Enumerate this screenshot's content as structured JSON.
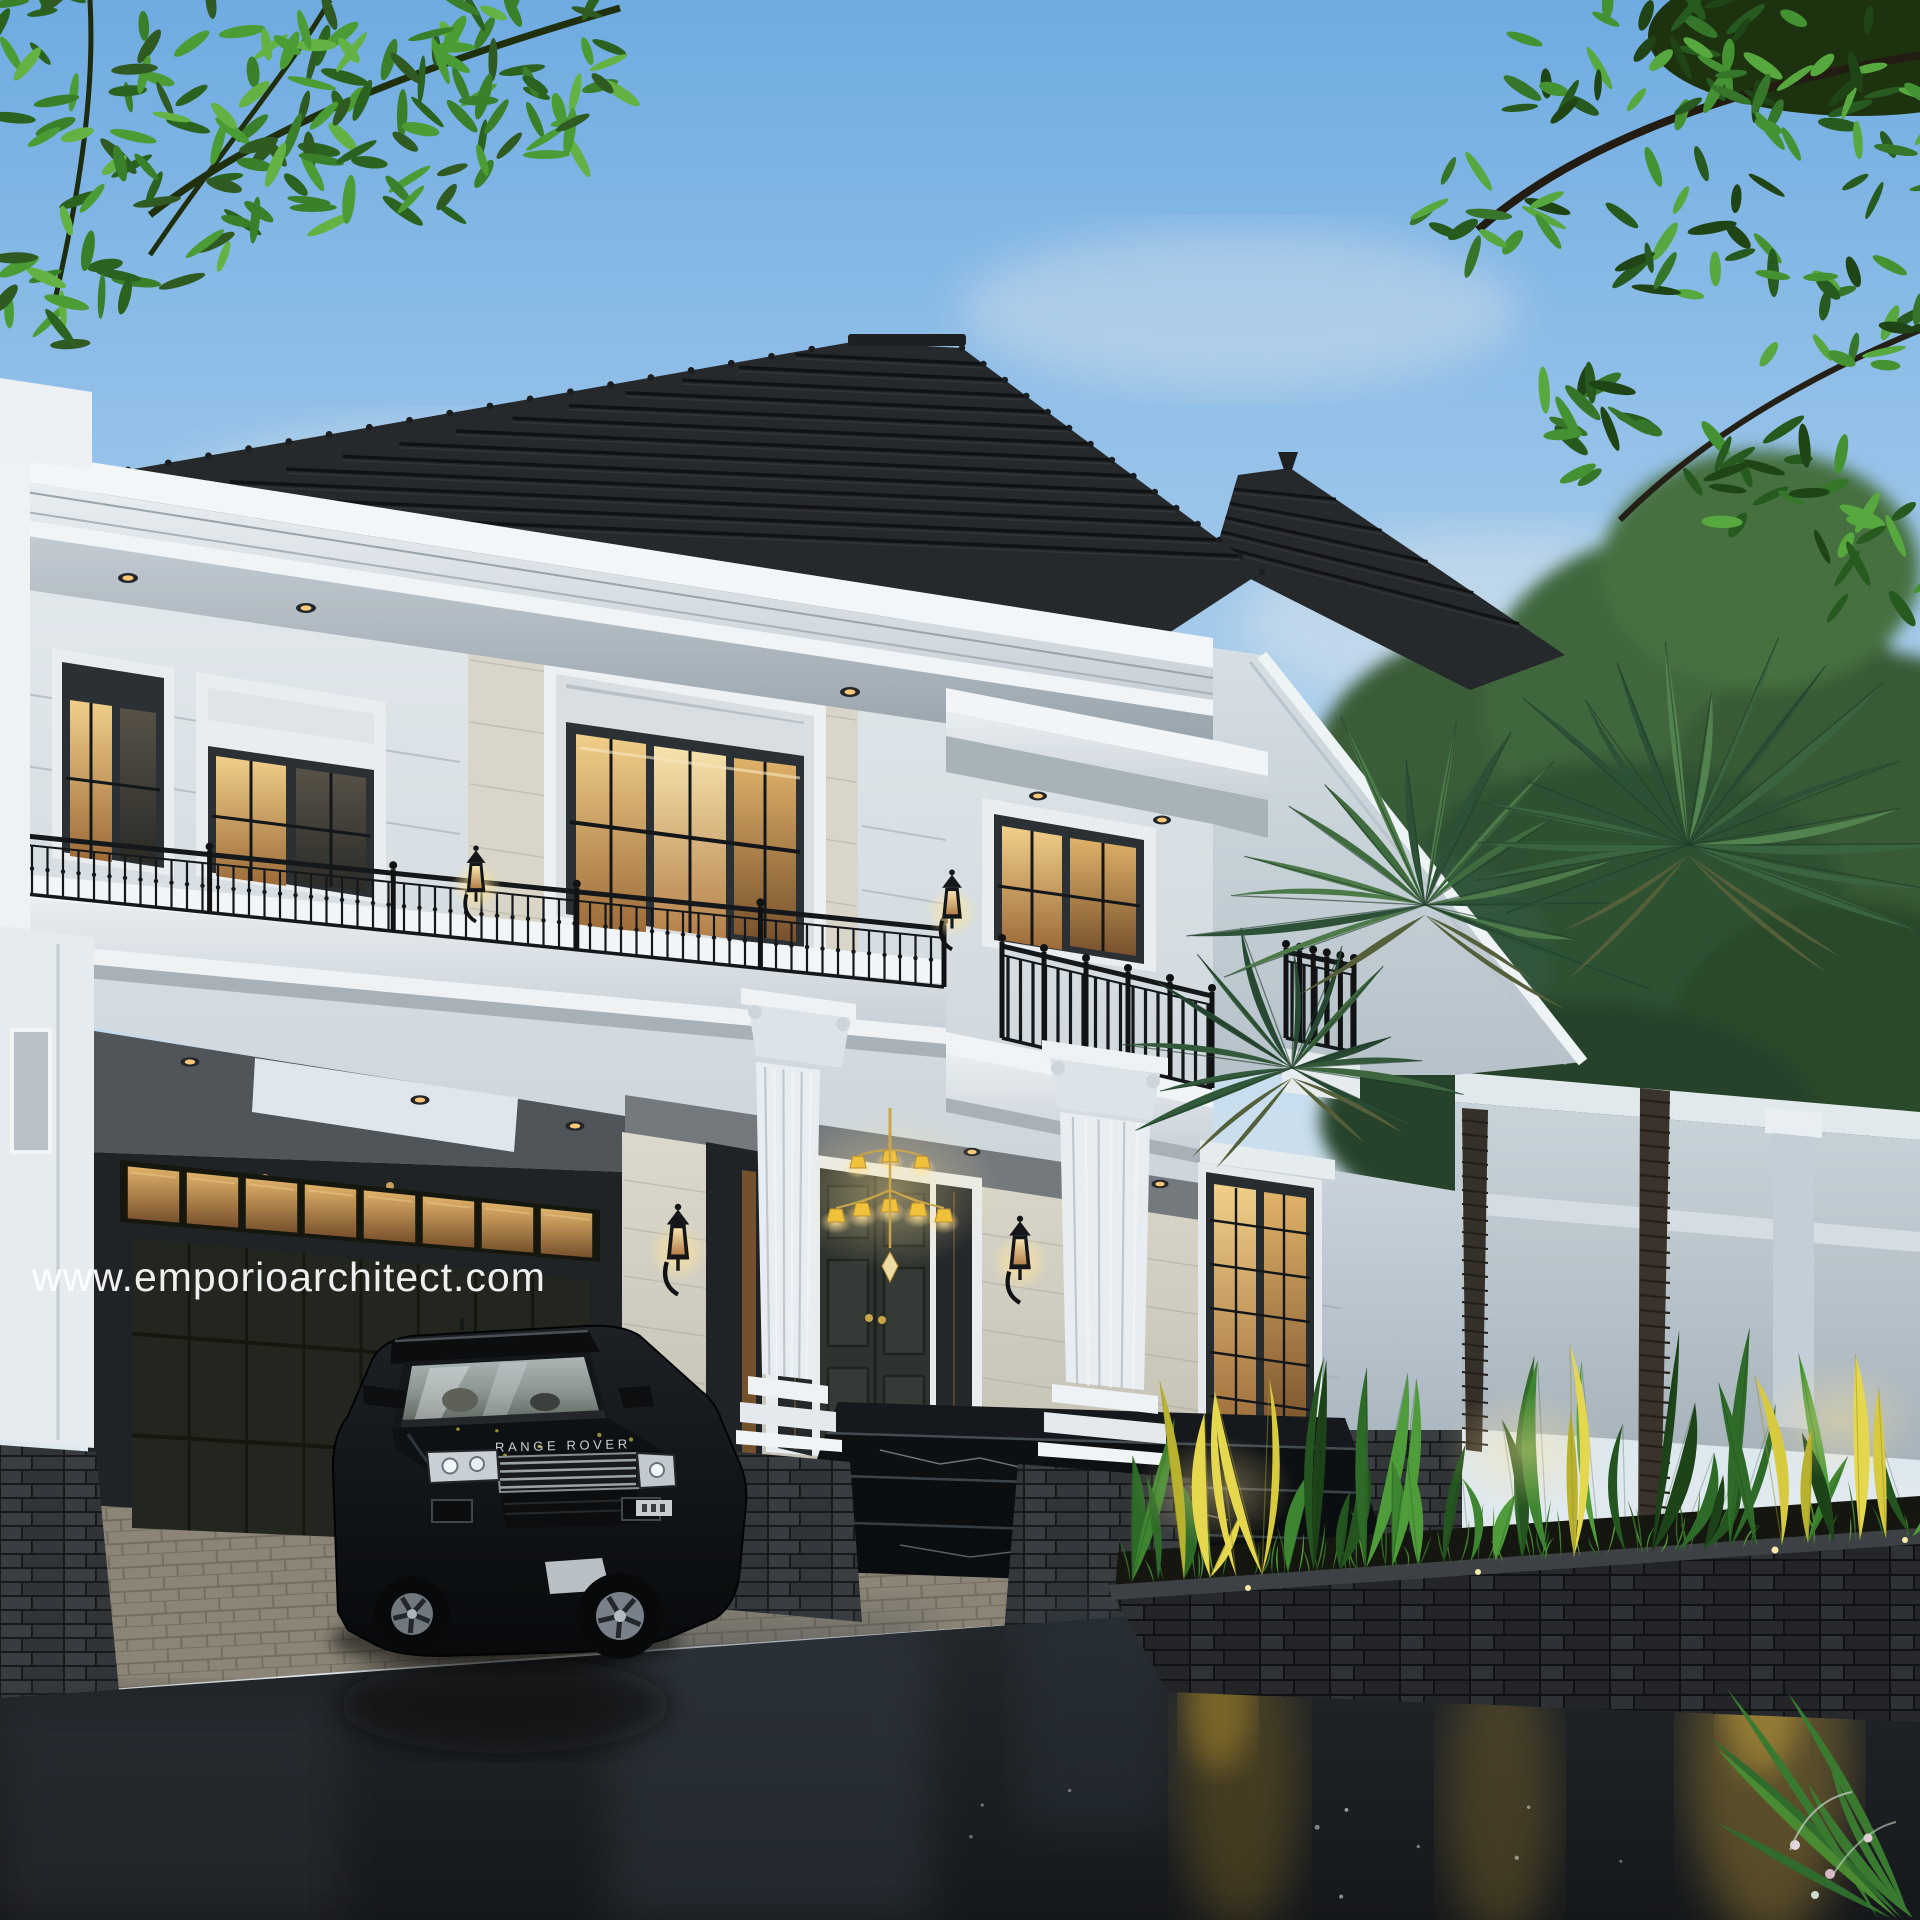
{
  "watermark": {
    "text": "www.emporioarchitect.com"
  },
  "car": {
    "brand_text": "RANGE ROVER"
  },
  "colors": {
    "sky_top": "#6fabe1",
    "sky_horizon": "#e6eaec",
    "roof": "#26292c",
    "facade_white": "#e9edf0",
    "cornice": "#f4f7f9",
    "travertine": "#d8d5c8",
    "window_frame": "#2b3034",
    "warm_light": "#ffd97d",
    "iron_railing": "#14161a",
    "foliage_green": "#3f8a2e",
    "palm_green": "#3f6b3f",
    "stone_dark": "#303437",
    "marble_black": "#0d1013",
    "asphalt": "#22262a",
    "paver_gray": "#8b8984",
    "garden_glow": "#c9a43c",
    "watermark": "#ffffff"
  }
}
